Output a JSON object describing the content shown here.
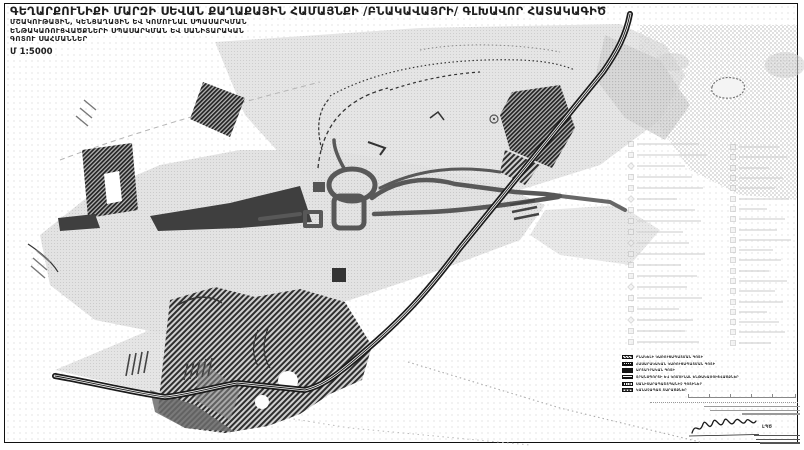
{
  "title": {
    "main": "ԳԵՂԱՐՔՈՒՆԻՔԻ ՄԱՐԶԻ ՍԵՎԱՆ ՔԱՂԱՔԱՅԻՆ ՀԱՄԱՅՆՔԻ /ԲՆԱԿԱՎԱՅՐԻ/ ԳԼԽԱՎՈՐ ՀԱՏԱԿԱԳԻԾ",
    "sub1": "ՄՇԱԿՈՒԹԱՅԻՆ, ԿԵՆՑԱՂԱՅԻՆ ԵՎ ԿՈՄՈՒՆԱԼ ՍՊԱՍԱՐԿՄԱՆ",
    "sub2": "ԵՆԹԱԿԱՌՈՒՑՎԱԾՔՆԵՐԻ ՍՊԱՍԱՐԿՄԱՆ ԵՎ ՍԱՆԻՏԱՐԱԿԱՆ",
    "sub3": "ԳՈՏՈՒ ՍԱՀՄԱՆՆԵՐ",
    "scale": "Մ 1:5000"
  },
  "legend": {
    "items": [
      {
        "label": "ԲՆԱԿԵԼԻ ԿԱՌՈՒՑԱՊԱՏՄԱՆ ԳՈՏԻ",
        "pattern": "sw-hatch"
      },
      {
        "label": "ՀԱՍԱՐԱԿԱԿԱՆ ԿԱՌՈՒՑԱՊԱՏՄԱՆ ԳՈՏԻ",
        "pattern": "sw-check"
      },
      {
        "label": "ԱՐՏԱԴՐԱԿԱՆ ԳՈՏԻ",
        "pattern": "sw-solid"
      },
      {
        "label": "ՏՐԱՆՍՊՈՐՏԻ ԵՎ ԿՈՄՈՒՆԱԼ ԵՆԹԱԿԱՌՈՒՑՎԱԾՔՆԵՐ",
        "pattern": "sw-hlines"
      },
      {
        "label": "ՍԱՆԻՏԱՐԱՊԱՇՏՊԱՆԻՉ ԳՈՏԻՆԵՐ",
        "pattern": "sw-vlines"
      },
      {
        "label": "ԿԱՆԱՉԱՊԱՏ ՏԱՐԱԾՔՆԵՐ",
        "pattern": "sw-cross"
      }
    ]
  },
  "faint_legend": {
    "left_widths": [
      62,
      70,
      48,
      55,
      66,
      40,
      58,
      64,
      46,
      52,
      68,
      44,
      60,
      50,
      65,
      42,
      56,
      48,
      62
    ],
    "left_diamond": [
      2,
      5,
      9,
      13,
      16
    ],
    "right_widths": [
      40,
      48,
      30,
      44,
      36,
      50,
      28,
      46,
      38,
      52,
      34,
      42,
      30,
      48,
      36,
      44,
      28,
      40,
      46,
      32
    ]
  },
  "stamp": {
    "signature_label": "ԼՊԾ",
    "upper_lines": [
      96,
      90,
      58
    ],
    "lower_lines": [
      46,
      44,
      40
    ]
  },
  "colors": {
    "ink": "#1f1f1f",
    "terrain_light": "#e0e0e0",
    "terrain_mid": "#cccccc",
    "road": "#585858",
    "zone_dark": "#3f3f3f",
    "railway": "#1a1a1a"
  }
}
